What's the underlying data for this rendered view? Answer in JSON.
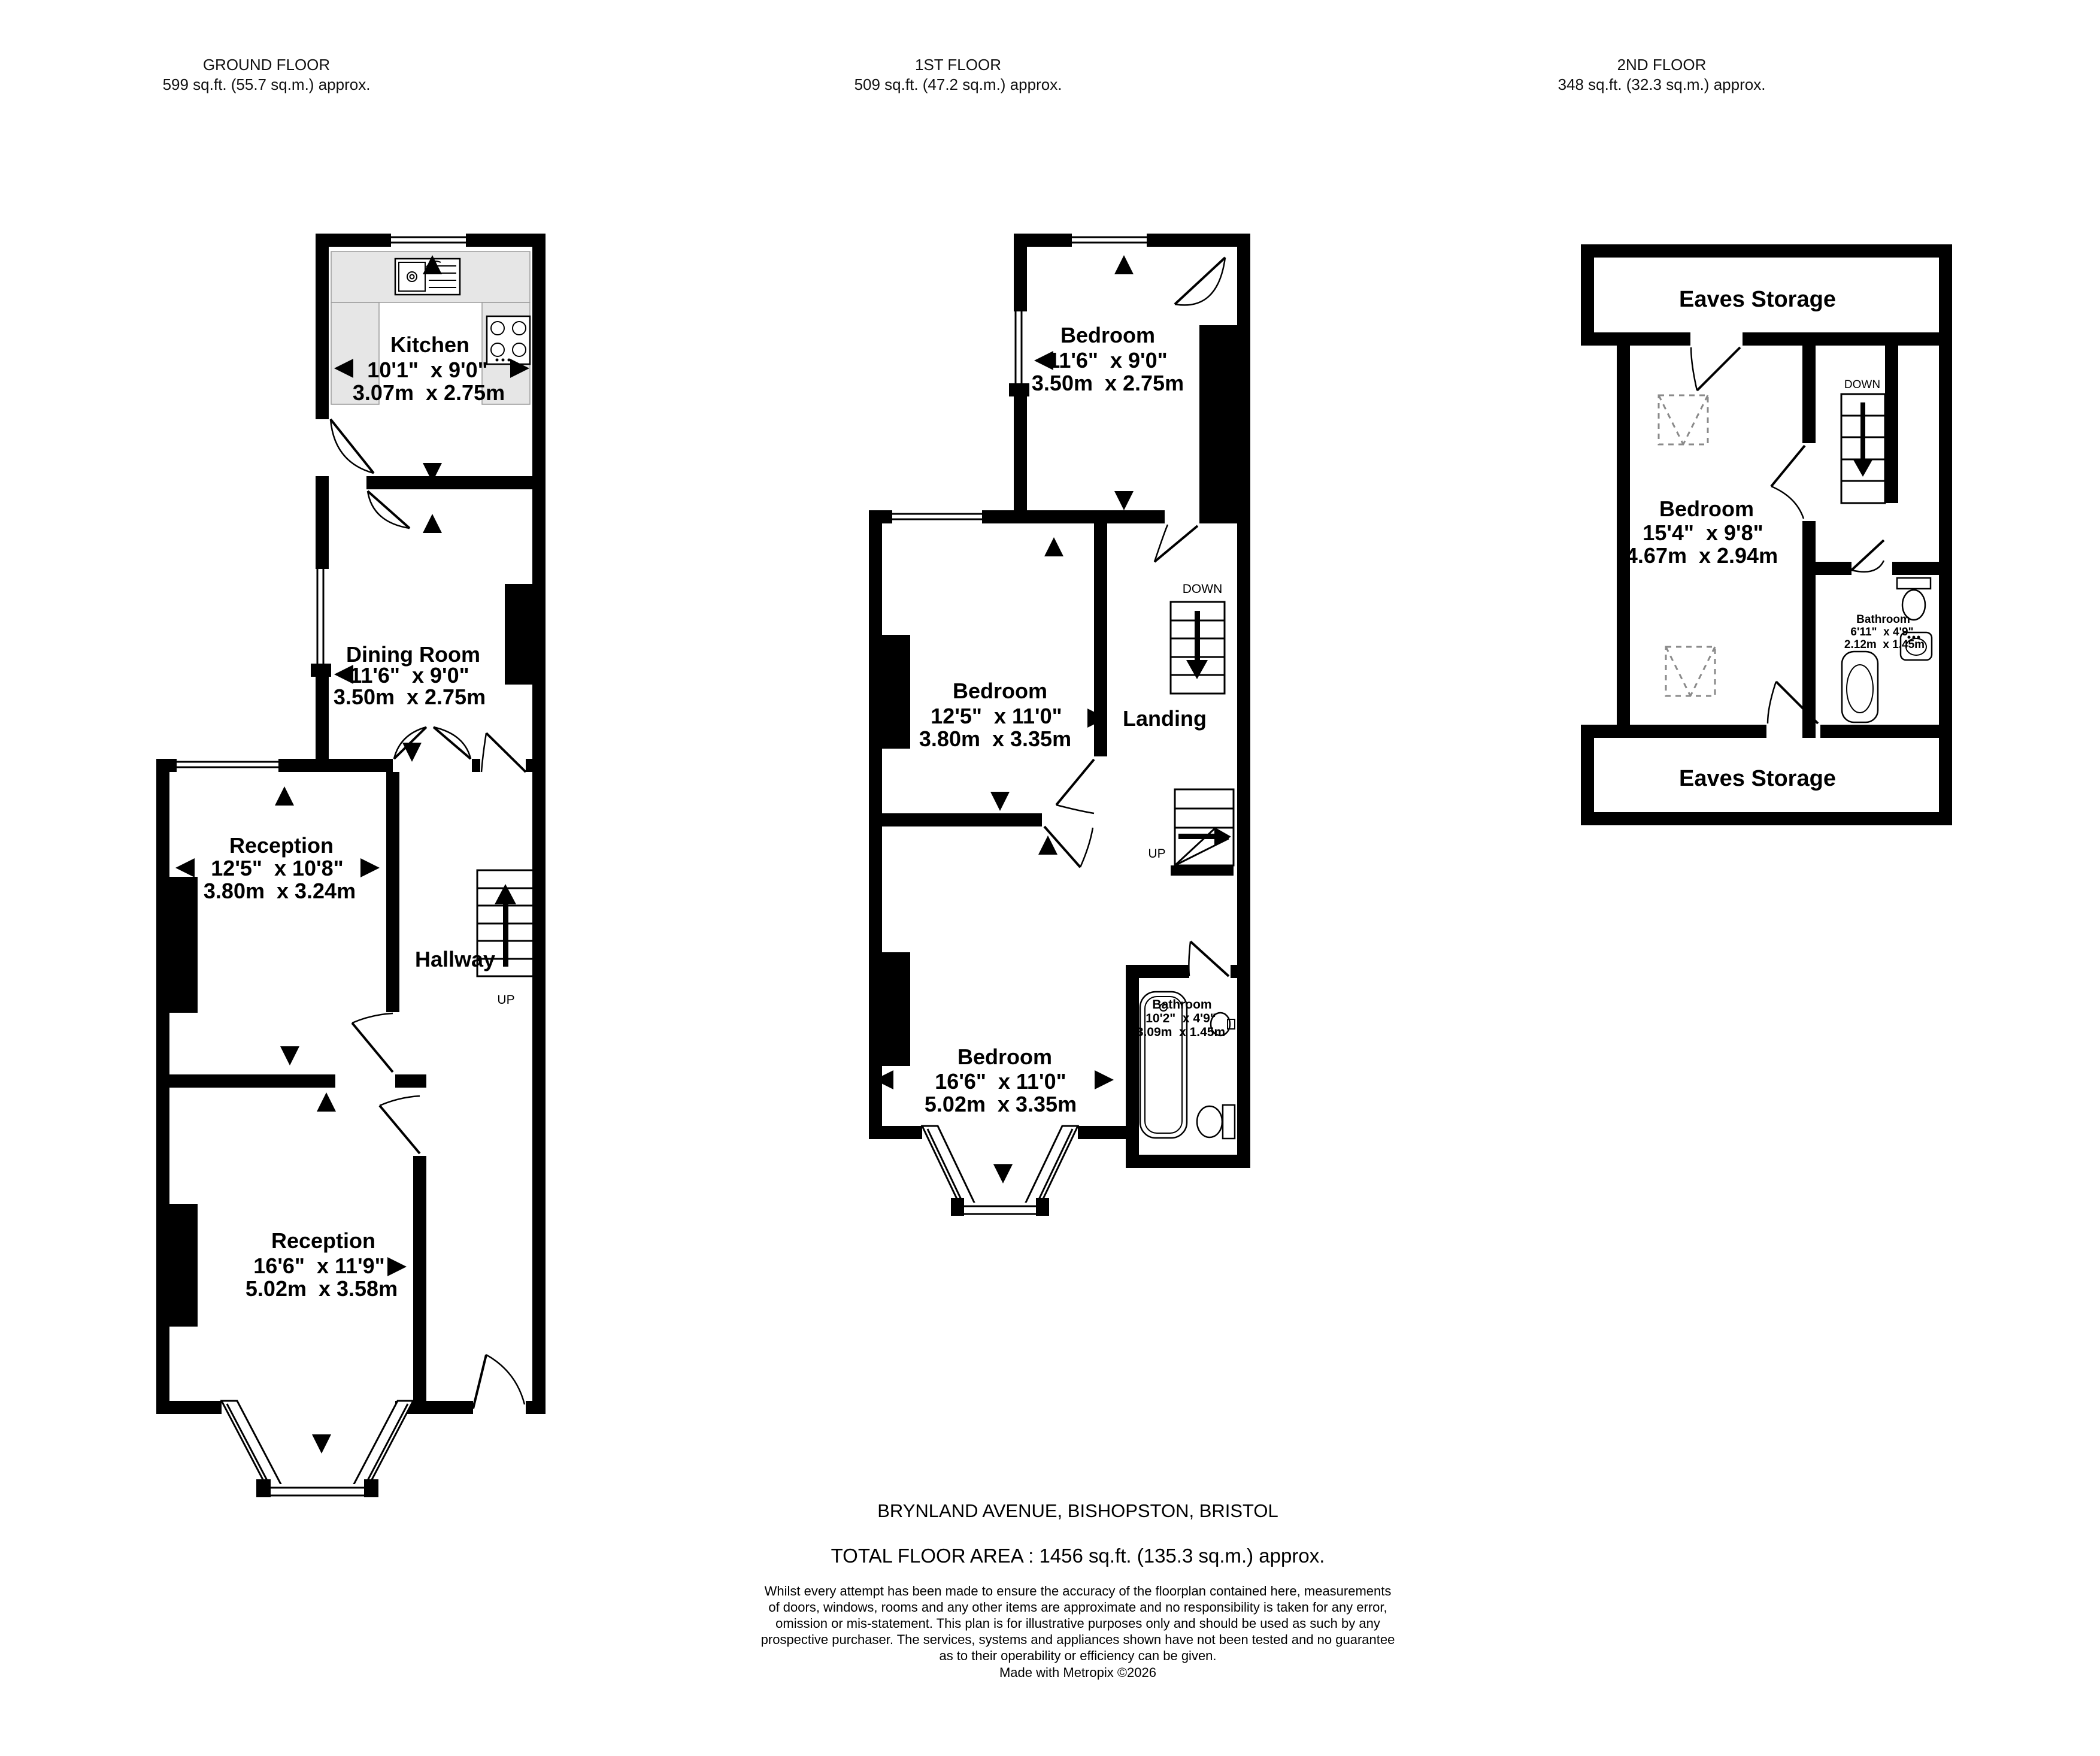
{
  "floors": [
    {
      "title": "GROUND FLOOR",
      "area": "599 sq.ft. (55.7 sq.m.) approx.",
      "rooms": [
        {
          "name": "Kitchen",
          "imperial": "10'1\"  x 9'0\"",
          "metric": "3.07m  x 2.75m"
        },
        {
          "name": "Dining Room",
          "imperial": "11'6\"  x 9'0\"",
          "metric": "3.50m  x 2.75m"
        },
        {
          "name": "Reception",
          "imperial": "12'5\"  x 10'8\"",
          "metric": "3.80m  x 3.24m"
        },
        {
          "name": "Hallway"
        },
        {
          "name": "Reception",
          "imperial": "16'6\"  x 11'9\"",
          "metric": "5.02m  x 3.58m"
        }
      ],
      "labels": {
        "up": "UP"
      }
    },
    {
      "title": "1ST FLOOR",
      "area": "509 sq.ft. (47.2 sq.m.) approx.",
      "rooms": [
        {
          "name": "Bedroom",
          "imperial": "11'6\"  x 9'0\"",
          "metric": "3.50m  x 2.75m"
        },
        {
          "name": "Bedroom",
          "imperial": "12'5\"  x 11'0\"",
          "metric": "3.80m  x 3.35m"
        },
        {
          "name": "Landing"
        },
        {
          "name": "Bathroom",
          "imperial": "10'2\"  x 4'9\"",
          "metric": "3.09m  x 1.45m"
        },
        {
          "name": "Bedroom",
          "imperial": "16'6\"  x 11'0\"",
          "metric": "5.02m  x 3.35m"
        }
      ],
      "labels": {
        "up": "UP",
        "down": "DOWN"
      }
    },
    {
      "title": "2ND FLOOR",
      "area": "348 sq.ft. (32.3 sq.m.) approx.",
      "rooms": [
        {
          "name": "Eaves Storage"
        },
        {
          "name": "Bedroom",
          "imperial": "15'4\"  x 9'8\"",
          "metric": "4.67m  x 2.94m"
        },
        {
          "name": "Bathroom",
          "imperial": "6'11\"  x 4'9\"",
          "metric": "2.12m  x 1.45m"
        },
        {
          "name": "Eaves Storage"
        }
      ],
      "labels": {
        "down": "DOWN"
      }
    }
  ],
  "footer": {
    "address": "BRYNLAND AVENUE, BISHOPSTON, BRISTOL",
    "total_area": "TOTAL FLOOR AREA : 1456 sq.ft. (135.3 sq.m.) approx.",
    "disclaimer": "Whilst every attempt has been made to ensure the accuracy of the floorplan contained here, measurements\nof doors, windows, rooms and any other items are approximate and no responsibility is taken for any error,\nomission or mis-statement. This plan is for illustrative purposes only and should be used as such by any\nprospective purchaser. The services, systems and appliances shown have not been tested and no guarantee\nas to their operability or efficiency can be given.",
    "credit": "Made with Metropix ©2026"
  },
  "colors": {
    "wall": "#000000",
    "counter": "#e6e6e6"
  }
}
